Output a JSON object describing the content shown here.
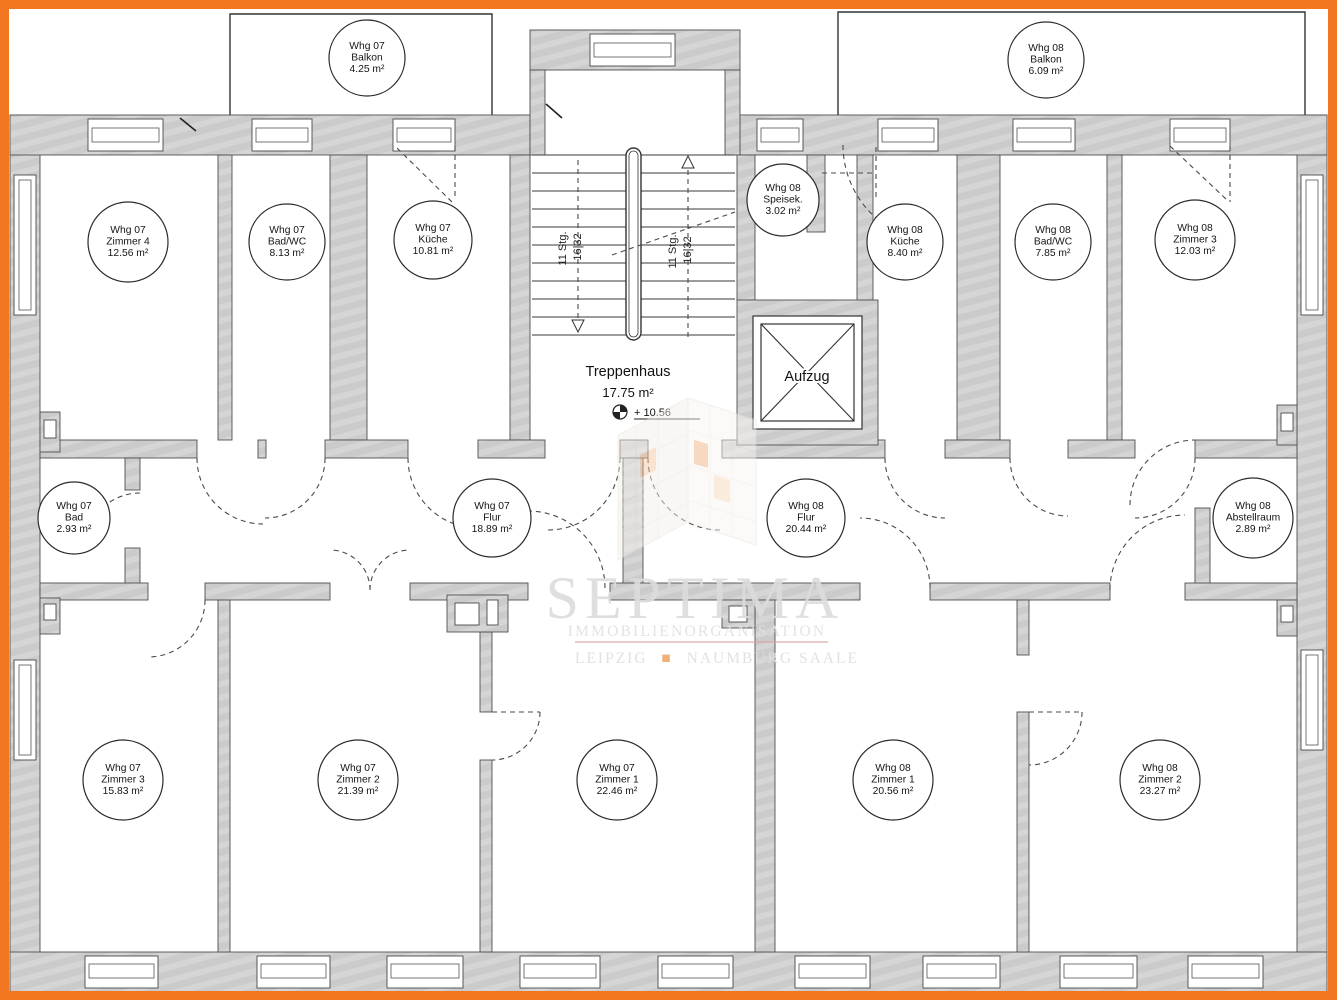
{
  "colors": {
    "frame_orange": "#f2761f",
    "wall_gray": "#cbcbcb",
    "line_dark": "#4a4a4a",
    "watermark_orange": "#efa968"
  },
  "room_labels": [
    {
      "apt": "Whg 07",
      "name": "Balkon",
      "area": "4.25 m²"
    },
    {
      "apt": "Whg 07",
      "name": "Zimmer 4",
      "area": "12.56 m²"
    },
    {
      "apt": "Whg 07",
      "name": "Bad/WC",
      "area": "8.13 m²"
    },
    {
      "apt": "Whg 07",
      "name": "Küche",
      "area": "10.81 m²"
    },
    {
      "apt": "Whg 08",
      "name": "Balkon",
      "area": "6.09 m²"
    },
    {
      "apt": "Whg 08",
      "name": "Speisek.",
      "area": "3.02 m²"
    },
    {
      "apt": "Whg 08",
      "name": "Küche",
      "area": "8.40 m²"
    },
    {
      "apt": "Whg 08",
      "name": "Bad/WC",
      "area": "7.85 m²"
    },
    {
      "apt": "Whg 08",
      "name": "Zimmer 3",
      "area": "12.03 m²"
    },
    {
      "apt": "Whg 07",
      "name": "Bad",
      "area": "2.93 m²"
    },
    {
      "apt": "Whg 07",
      "name": "Flur",
      "area": "18.89 m²"
    },
    {
      "apt": "Whg 08",
      "name": "Flur",
      "area": "20.44 m²"
    },
    {
      "apt": "Whg 08",
      "name": "Abstellraum",
      "area": "2.89 m²"
    },
    {
      "apt": "Whg 07",
      "name": "Zimmer 3",
      "area": "15.83 m²"
    },
    {
      "apt": "Whg 07",
      "name": "Zimmer 2",
      "area": "21.39 m²"
    },
    {
      "apt": "Whg 07",
      "name": "Zimmer 1",
      "area": "22.46 m²"
    },
    {
      "apt": "Whg 08",
      "name": "Zimmer 1",
      "area": "20.56 m²"
    },
    {
      "apt": "Whg 08",
      "name": "Zimmer 2",
      "area": "23.27 m²"
    }
  ],
  "stairwell": {
    "name": "Treppenhaus",
    "area": "17.75 m²",
    "level": "+ 10.56",
    "steps": "11 Stg.",
    "rise_run": "16|32",
    "elevator": "Aufzug"
  },
  "watermark": {
    "brand": "SEPTIMA",
    "subtitle": "IMMOBILIENORGANISATION",
    "city_left": "LEIPZIG",
    "bullet": "■",
    "city_right": "NAUMBURG SAALE"
  }
}
